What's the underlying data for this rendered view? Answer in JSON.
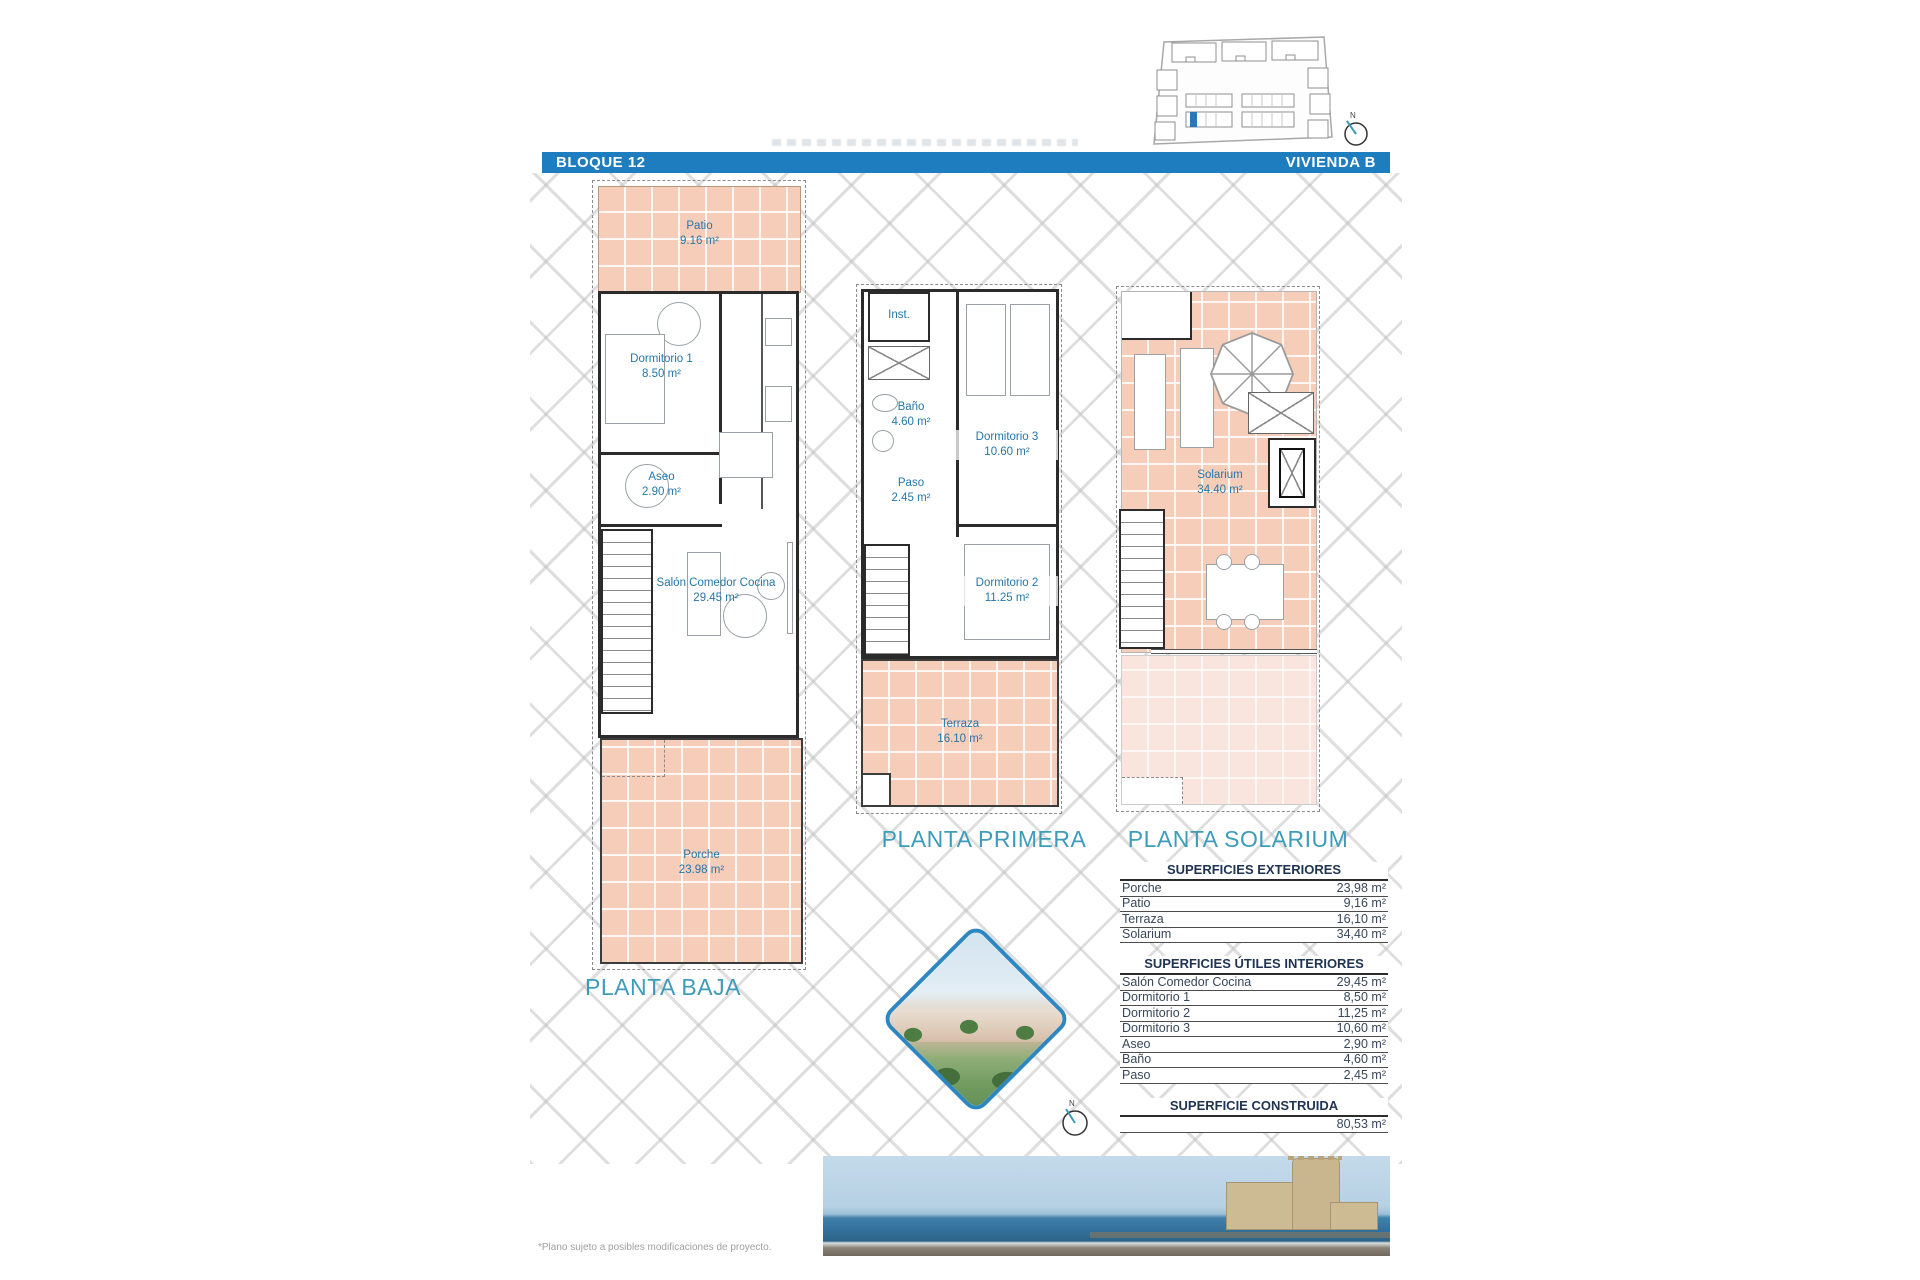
{
  "header": {
    "left": "BLOQUE 12",
    "right": "VIVIENDA B"
  },
  "site_plan": {
    "compass_label": "N"
  },
  "compass2": {
    "label": "N"
  },
  "plan_baja": {
    "title": "PLANTA BAJA",
    "patio_name": "Patio",
    "patio_area": "9.16 m²",
    "dorm1_name": "Dormitorio 1",
    "dorm1_area": "8.50 m²",
    "aseo_name": "Aseo",
    "aseo_area": "2.90 m²",
    "salon_name": "Salón Comedor Cocina",
    "salon_area": "29.45 m²",
    "porche_name": "Porche",
    "porche_area": "23.98 m²"
  },
  "plan_primera": {
    "title": "PLANTA PRIMERA",
    "inst_name": "Inst.",
    "bano_name": "Baño",
    "bano_area": "4.60 m²",
    "dorm3_name": "Dormitorio 3",
    "dorm3_area": "10.60 m²",
    "paso_name": "Paso",
    "paso_area": "2.45 m²",
    "dorm2_name": "Dormitorio 2",
    "dorm2_area": "11.25 m²",
    "terraza_name": "Terraza",
    "terraza_area": "16.10 m²"
  },
  "plan_solarium": {
    "title": "PLANTA SOLARIUM",
    "solarium_name": "Solarium",
    "solarium_area": "34.40 m²"
  },
  "tables": [
    {
      "title": "SUPERFICIES EXTERIORES",
      "rows": [
        [
          "Porche",
          "23,98 m²"
        ],
        [
          "Patio",
          "9,16 m²"
        ],
        [
          "Terraza",
          "16,10 m²"
        ],
        [
          "Solarium",
          "34,40 m²"
        ]
      ]
    },
    {
      "title": "SUPERFICIES ÚTILES INTERIORES",
      "rows": [
        [
          "Salón Comedor Cocina",
          "29,45 m²"
        ],
        [
          "Dormitorio 1",
          "8,50 m²"
        ],
        [
          "Dormitorio 2",
          "11,25 m²"
        ],
        [
          "Dormitorio 3",
          "10,60 m²"
        ],
        [
          "Aseo",
          "2,90 m²"
        ],
        [
          "Baño",
          "4,60 m²"
        ],
        [
          "Paso",
          "2,45 m²"
        ]
      ]
    },
    {
      "title": "SUPERFICIE CONSTRUIDA",
      "rows": [
        [
          "",
          "80,53 m²"
        ]
      ]
    }
  ],
  "footnote": "*Plano sujeto a posibles modificaciones de proyecto.",
  "colors": {
    "header_blue": "#1e7dbe",
    "salmon": "#f6cdb8",
    "salmon_light": "#f9e5de",
    "plan_title_teal": "#3d9cba",
    "room_label_blue": "#2577a8",
    "highlight_blue": "#2e75b6"
  }
}
